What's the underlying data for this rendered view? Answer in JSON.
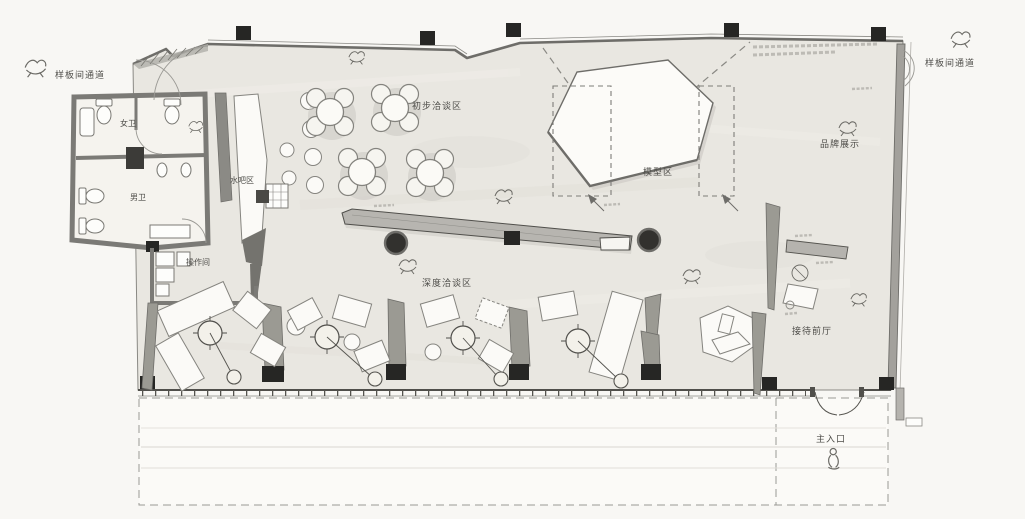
{
  "plan": {
    "labels": {
      "corridor_left": "样板间通道",
      "corridor_right": "样板间通道",
      "womens_wc": "女卫",
      "mens_wc": "男卫",
      "water_bar": "水吧区",
      "operation_room": "操作间",
      "initial_negotiation": "初步洽谈区",
      "deep_negotiation": "深度洽谈区",
      "model_area": "模型区",
      "brand_display": "品牌展示",
      "reception_hall": "接待前厅",
      "main_entrance": "主入口"
    },
    "colors": {
      "paper": "#f8f7f4",
      "floor": "#e9e7e1",
      "wall_gray": "#7b7a76",
      "partition_gray": "#9b9a93",
      "column_black": "#262624",
      "furniture_white": "#fbfaf7",
      "label_text": "#4e4d49"
    }
  }
}
